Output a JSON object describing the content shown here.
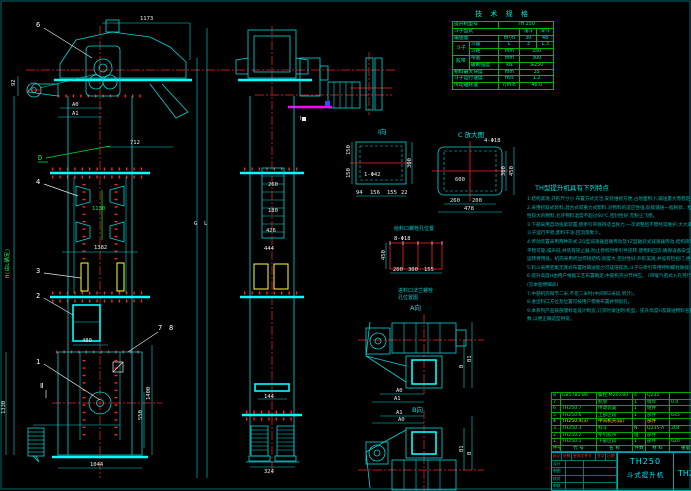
{
  "colors": {
    "background": "#000000",
    "line_cyan": "#00d8d8",
    "bright_cyan": "#00ffff",
    "centerline_red": "#ff2020",
    "table_green": "#00b400",
    "text_green": "#21e558",
    "bucket_yellow": "#ffff33",
    "magenta": "#ff00ff",
    "note_teal": "#00b4b4"
  },
  "spec_table": {
    "title": "技 术 规 格",
    "r1_label": "提升机型号",
    "r1_value": "TH 250",
    "r2_label": "斗子型式",
    "r2_v1": "浅斗",
    "r2_v2": "深斗",
    "r3_label": "输送量",
    "r3_unit": "m³/h",
    "r3_v1": "30",
    "r3_v2": "48",
    "g1": "斗子",
    "r4_label": "斗容",
    "r4_unit": "L",
    "r4_v1": "3",
    "r4_v2": "1.3",
    "r5_label": "斗距",
    "r5_unit": "mm",
    "r5_value": "350",
    "g2": "胶带",
    "r6_label": "带宽",
    "r6_unit": "mm",
    "r6_value": "300",
    "r7_label": "破断强度",
    "r7_unit": "kN",
    "r7_value": "≥250",
    "r8_label": "物料最大块度",
    "r8_unit": "mm",
    "r8_value": "35",
    "r9_label": "斗子运行速度",
    "r9_unit": "m/s",
    "r9_value": "1.2",
    "r10_label": "传动轴转速",
    "r10_unit": "r/min",
    "r10_value": "46.0"
  },
  "notes": {
    "title": "TH型提升机具有下列特点",
    "lines": [
      "1.结构紧凑,外形尺寸小,布置方式灵活,安装维修方便,占地面积小,输送量大而稳定一致。",
      "2.采用挖取式装料,混合式或重力式卸料,对物料的适应性强,既能输送一般粉状、粒状物料,也可输送磨琢",
      "  性较大的物料,允许物料温度不超过60℃,密封性好,无粉尘飞扬。",
      "3.下部采用自动张紧装置,使牵引带保持适当张力,一次调整后不需经常维护,大大减少了维护工作量,保证",
      "  斗子运行平稳,卸料干净,回流现象少。",
      "4.传动装置采用两种形式:ZQ型减速器直联传动及YZ型轴装式减速器传动,结构简单紧凑,安装方便,运转",
      "  平稳可靠,噪声低,并装有逆止器,防止停机时牵引件逆转,使物料回流,确保设备安全可靠,使用寿命长,",
      "  运转费用低。机壳采用折边焊接结构,刚度大,密封性好,外形美观,并设有检视门,便于检修。",
      "5.料斗采用密集无底式布置时输送能力可成倍提高,斗子与牵引带用特制螺栓联接,装拆方便,连接可靠。",
      "6.提升高度H由用户根据工艺布置确定,中部机壳分节供应。        (带喉气密式入孔另行规定)",
      "  (见本图明细表)",
      "7.中部机壳每节二米,不足二米时(中间带2米段,另计)。",
      "8.进出料口方位及位置可按用户需要布置并预留孔。",
      "9.本系列产品按部颁标准设计制造,订货时请注明:机型、提升高度H及输送物料名称、粒度、温度等性能参",
      "  数,以便正确选型供货。"
    ]
  },
  "bom": {
    "headers": [
      "件号",
      "代  号",
      "名  称",
      "件数",
      "材 料",
      "重量"
    ],
    "rows": [
      {
        "no": "8",
        "code": "GB5782-86",
        "name": "螺栓 M20×80",
        "qty": "4",
        "mat": "Q235",
        "wt": ""
      },
      {
        "no": "7",
        "code": "",
        "name": "机架",
        "qty": "1",
        "mat": "组焊",
        "wt": "0.0"
      },
      {
        "no": "6",
        "code": "TH250.7",
        "name": "传动装置",
        "qty": "1",
        "mat": "组件",
        "wt": ""
      },
      {
        "no": "5",
        "code": "TH250.6",
        "name": "上部区段",
        "qty": "1",
        "mat": "部件",
        "wt": "635"
      },
      {
        "no": "4",
        "code": "TH250.4(3)",
        "name": "中间机壳(段)",
        "qty": "",
        "mat": "部件",
        "wt": ""
      },
      {
        "no": "3",
        "code": "TH250.3",
        "name": "料斗",
        "qty": "N",
        "mat": "Q235-A",
        "wt": "204"
      },
      {
        "no": "2",
        "code": "TH250.2",
        "name": "牵引胶带",
        "qty": "组",
        "mat": "部件",
        "wt": ""
      },
      {
        "no": "1",
        "code": "TH250.1",
        "name": "下部区段",
        "qty": "1",
        "mat": "部件",
        "wt": "620"
      }
    ]
  },
  "title_block": {
    "model": "TH250",
    "product": "斗式提升机",
    "code_right": "TH25",
    "mark_row": [
      "标记",
      "处数",
      "更改文件号",
      "签字",
      "日期"
    ],
    "sig_rows": [
      "设计",
      "制图",
      "校对",
      "审核"
    ]
  },
  "front": {
    "c6": "6",
    "c4": "4",
    "c3": "3",
    "c2": "2",
    "c1": "1",
    "c7": "7",
    "c8": "8",
    "d_label": "D",
    "sec2": "Ⅱ",
    "dim1173": "1173",
    "dim712": "712",
    "dim92": "92",
    "a0": "A0",
    "a1": "A1",
    "dim1130": "1130",
    "dim1382": "1382",
    "h_label": "H(由L确定)",
    "g": "G",
    "l": "L",
    "dim480": "480",
    "dim1400": "1400",
    "dim550": "550",
    "dim1330": "1330",
    "dim1044": "1044"
  },
  "side": {
    "dim260": "260",
    "dim180": "180",
    "dim426": "426",
    "dim444": "444",
    "dim144": "144",
    "dim324": "324",
    "sec1": "Ⅰ"
  },
  "view_i": {
    "title": "Ⅰ向",
    "hole": "1-Φ42",
    "left1": "150",
    "left2": "150",
    "right": "300",
    "b1": "94",
    "b2": "156",
    "b3": "155",
    "b4": "22"
  },
  "view_c": {
    "title": "C 放大图",
    "hole": "4-Φ18",
    "center": "600",
    "r_in": "300",
    "r_out": "450",
    "b1": "260",
    "b2": "200",
    "total": "478"
  },
  "feed": {
    "title": "给料口螺栓孔位置",
    "hole": "8-Φ18",
    "left": "450",
    "b1": "200",
    "b2": "300",
    "b3": "155",
    "note1": "进料口法兰螺栓",
    "note2": "孔位置图",
    "a_label": "A向"
  },
  "plans": {
    "b_label": "B向",
    "a0": "A0",
    "a1": "A1",
    "b": "B",
    "b1": "B1",
    "a1b": "A1",
    "a0b": "A0",
    "b1b": "B1",
    "bb": "B"
  }
}
